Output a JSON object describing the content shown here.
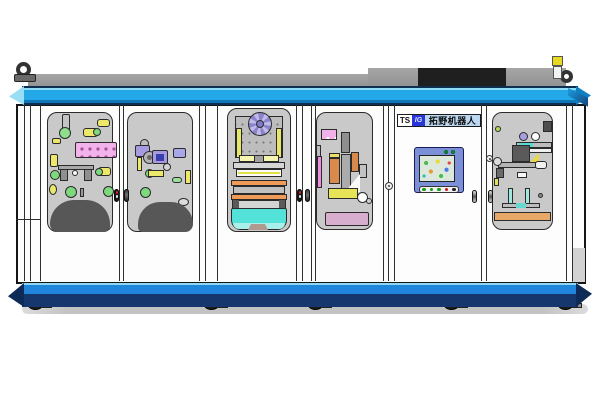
{
  "machine": {
    "label_plate": {
      "ts": "TS",
      "logo": "IG",
      "brand": "拓野机器人"
    },
    "colors": {
      "beam_cyan": "#25a8e8",
      "beam_bottom_blue": "#2285dc",
      "beam_navy": "#16366e",
      "body": "#fdfdfd",
      "window_bg": "#c9c9c9",
      "dome": "#575757",
      "tray_cyan": "#52e2da",
      "accent_orange": "#f09a58",
      "hmi_frame": "#7b90d6"
    },
    "hmi": {
      "indicator_colors": [
        "#129a12",
        "#129a12"
      ],
      "button_colors": [
        "#15a015",
        "#15a015",
        "#15a015",
        "#cc1515",
        "#222222"
      ]
    }
  },
  "scene": {
    "frame_lines": [
      24,
      30,
      40,
      119,
      123,
      199,
      205,
      217,
      296,
      302,
      311,
      315,
      383,
      388,
      394,
      481,
      486,
      566,
      572
    ],
    "windows": [
      {
        "id": "w1",
        "x": 47,
        "y": 112,
        "w": 66,
        "h": 120
      },
      {
        "id": "w2",
        "x": 127,
        "y": 112,
        "w": 66,
        "h": 120
      },
      {
        "id": "w3",
        "x": 227,
        "y": 108,
        "w": 64,
        "h": 124
      },
      {
        "id": "w4",
        "x": 316,
        "y": 112,
        "w": 57,
        "h": 118
      },
      {
        "id": "w6",
        "x": 492,
        "y": 112,
        "w": 61,
        "h": 118
      }
    ],
    "handles": [
      {
        "x": 114,
        "y": 189,
        "v": "lock"
      },
      {
        "x": 124,
        "y": 189,
        "v": "dark"
      },
      {
        "x": 297,
        "y": 189,
        "v": "lock"
      },
      {
        "x": 305,
        "y": 189,
        "v": "dark"
      },
      {
        "x": 472,
        "y": 190,
        "v": "light"
      },
      {
        "x": 488,
        "y": 190,
        "v": "light"
      }
    ],
    "knobs": [
      {
        "x": 385,
        "y": 182,
        "d": 8
      },
      {
        "x": 486,
        "y": 155,
        "d": 7
      }
    ],
    "casters": [
      36,
      212,
      316,
      452,
      566
    ],
    "components": [
      {
        "n": "air-cylinder",
        "x": 62,
        "y": 114,
        "w": 8,
        "h": 17,
        "c": "#c4c4c4",
        "r": "2px",
        "b": true
      },
      {
        "n": "cylinder-base",
        "x": 59,
        "y": 127,
        "w": 12,
        "h": 12,
        "c": "#8ede8e",
        "r": "50",
        "b": true
      },
      {
        "n": "sensor-yellow",
        "x": 97,
        "y": 119,
        "w": 13,
        "h": 8,
        "c": "#eee86a",
        "r": "3px",
        "b": true
      },
      {
        "n": "sensor-yellow",
        "x": 83,
        "y": 128,
        "w": 15,
        "h": 9,
        "c": "#eee86a",
        "r": "3px",
        "b": true
      },
      {
        "n": "sensor-end-green",
        "x": 93,
        "y": 128,
        "w": 8,
        "h": 8,
        "c": "#7ed87e",
        "r": "50",
        "b": true
      },
      {
        "n": "sensor-yellow",
        "x": 52,
        "y": 138,
        "w": 9,
        "h": 6,
        "c": "#eee86a",
        "r": "2px",
        "b": true
      },
      {
        "n": "valve-manifold",
        "x": 75,
        "y": 142,
        "w": 42,
        "h": 16,
        "c": "#f2b2ea",
        "r": "2px",
        "b": true,
        "cls": "dots"
      },
      {
        "n": "sensor-yellow",
        "x": 50,
        "y": 154,
        "w": 8,
        "h": 13,
        "c": "#eee86a",
        "r": "2px",
        "b": true
      },
      {
        "n": "indicator-green",
        "x": 50,
        "y": 170,
        "w": 10,
        "h": 10,
        "c": "#7ed87e",
        "r": "50",
        "b": true
      },
      {
        "n": "fixture-bar",
        "x": 58,
        "y": 165,
        "w": 36,
        "h": 5,
        "c": "#a8a8a8",
        "b": true
      },
      {
        "n": "fixture-post",
        "x": 60,
        "y": 169,
        "w": 8,
        "h": 12,
        "c": "#8f8f8f",
        "b": true
      },
      {
        "n": "fixture-post",
        "x": 84,
        "y": 169,
        "w": 8,
        "h": 12,
        "c": "#8f8f8f",
        "b": true
      },
      {
        "n": "fixture-hole",
        "x": 72,
        "y": 170,
        "w": 6,
        "h": 6,
        "c": "#f8f8f8",
        "r": "50",
        "b": true
      },
      {
        "n": "sensor-yellow",
        "x": 98,
        "y": 167,
        "w": 13,
        "h": 9,
        "c": "#eee86a",
        "r": "3px",
        "b": true
      },
      {
        "n": "sensor-end-green",
        "x": 95,
        "y": 168,
        "w": 8,
        "h": 8,
        "c": "#7ed87e",
        "r": "50",
        "b": true
      },
      {
        "n": "indicator-green",
        "x": 65,
        "y": 186,
        "w": 12,
        "h": 12,
        "c": "#7ed87e",
        "r": "50",
        "b": true
      },
      {
        "n": "indicator-green",
        "x": 103,
        "y": 186,
        "w": 11,
        "h": 11,
        "c": "#7ed87e",
        "r": "50",
        "b": true
      },
      {
        "n": "sensor-yellow",
        "x": 49,
        "y": 184,
        "w": 8,
        "h": 11,
        "c": "#e8e86a",
        "r": "50",
        "b": true
      },
      {
        "n": "pin",
        "x": 80,
        "y": 188,
        "w": 4,
        "h": 9,
        "c": "#9a9a9a",
        "b": true
      },
      {
        "n": "cover-dome",
        "x": 50,
        "y": 200,
        "w": 60,
        "h": 32,
        "c": "#575757",
        "r": "30px 30px 8px 10px"
      },
      {
        "n": "bearing",
        "x": 140,
        "y": 139,
        "w": 9,
        "h": 9,
        "c": "#bdbdbd",
        "r": "50",
        "b": true
      },
      {
        "n": "purple-block",
        "x": 135,
        "y": 145,
        "w": 15,
        "h": 12,
        "c": "#a89ae0",
        "r": "2px",
        "b": true
      },
      {
        "n": "motor-face",
        "x": 143,
        "y": 151,
        "w": 13,
        "h": 13,
        "c": "#b4b4b4",
        "r": "50",
        "b": true
      },
      {
        "n": "motor-hub",
        "x": 147,
        "y": 155,
        "w": 5,
        "h": 5,
        "c": "#666666",
        "r": "50"
      },
      {
        "n": "purple-block",
        "x": 152,
        "y": 150,
        "w": 16,
        "h": 14,
        "c": "#a89ae0",
        "r": "2px",
        "b": true
      },
      {
        "n": "purple-block-core",
        "x": 156,
        "y": 154,
        "w": 8,
        "h": 7,
        "c": "#3a3fae"
      },
      {
        "n": "violet-module",
        "x": 173,
        "y": 148,
        "w": 13,
        "h": 10,
        "c": "#a8a8e8",
        "r": "2px",
        "b": true
      },
      {
        "n": "sensor-yellow",
        "x": 137,
        "y": 157,
        "w": 5,
        "h": 14,
        "c": "#eee86a",
        "b": true
      },
      {
        "n": "indicator-green",
        "x": 145,
        "y": 169,
        "w": 9,
        "h": 9,
        "c": "#7ed87e",
        "r": "50",
        "b": true
      },
      {
        "n": "sensor-yellow",
        "x": 148,
        "y": 170,
        "w": 16,
        "h": 7,
        "c": "#eee86a",
        "b": true
      },
      {
        "n": "bearing",
        "x": 163,
        "y": 163,
        "w": 8,
        "h": 8,
        "c": "#d4d4d4",
        "r": "50",
        "b": true
      },
      {
        "n": "sensor-yellow",
        "x": 185,
        "y": 170,
        "w": 6,
        "h": 14,
        "c": "#eee86a",
        "b": true
      },
      {
        "n": "green-capsule",
        "x": 172,
        "y": 177,
        "w": 10,
        "h": 6,
        "c": "#9ede9e",
        "r": "3px",
        "b": true
      },
      {
        "n": "indicator-green",
        "x": 140,
        "y": 187,
        "w": 11,
        "h": 11,
        "c": "#7ed87e",
        "r": "50",
        "b": true
      },
      {
        "n": "bearing",
        "x": 178,
        "y": 198,
        "w": 11,
        "h": 8,
        "c": "#dcdcdc",
        "r": "50",
        "b": true
      },
      {
        "n": "cover-dome",
        "x": 138,
        "y": 202,
        "w": 55,
        "h": 30,
        "c": "#575757",
        "r": "28px 28px 10px 6px"
      },
      {
        "n": "press-plate",
        "x": 235,
        "y": 116,
        "w": 48,
        "h": 42,
        "c": "#bdbdbd",
        "b": true,
        "cls": "dots-sm"
      },
      {
        "n": "side-rail-yellow",
        "x": 236,
        "y": 128,
        "w": 6,
        "h": 30,
        "c": "#e6e66a",
        "b": true
      },
      {
        "n": "side-rail-yellow",
        "x": 276,
        "y": 128,
        "w": 6,
        "h": 30,
        "c": "#e6e66a",
        "b": true
      },
      {
        "n": "index-wheel",
        "x": 248,
        "y": 112,
        "w": 24,
        "h": 24,
        "r": "50",
        "b": true,
        "cls": "wheel"
      },
      {
        "n": "index-wheel-hub",
        "x": 256,
        "y": 120,
        "w": 8,
        "h": 8,
        "c": "#8079c8",
        "r": "50",
        "b": true
      },
      {
        "n": "pale-bar",
        "x": 239,
        "y": 155,
        "w": 40,
        "h": 7,
        "c": "#f4f4b0",
        "b": true
      },
      {
        "n": "center-bracket",
        "x": 254,
        "y": 155,
        "w": 10,
        "h": 11,
        "c": "#a0a0a0",
        "b": true
      },
      {
        "n": "cross-bar",
        "x": 233,
        "y": 162,
        "w": 52,
        "h": 7,
        "c": "#d6d6d6",
        "b": true
      },
      {
        "n": "roller-bed",
        "x": 236,
        "y": 169,
        "w": 46,
        "h": 8,
        "c": "#fafafa",
        "b": true
      },
      {
        "n": "roller-line",
        "x": 238,
        "y": 172,
        "w": 42,
        "h": 2,
        "c": "#e0e040"
      },
      {
        "n": "orange-rail",
        "x": 231,
        "y": 180,
        "w": 56,
        "h": 6,
        "c": "#f09a58",
        "b": true
      },
      {
        "n": "gray-band",
        "x": 233,
        "y": 186,
        "w": 52,
        "h": 8,
        "c": "#c0c0c0",
        "b": true
      },
      {
        "n": "orange-rail",
        "x": 231,
        "y": 194,
        "w": 56,
        "h": 6,
        "c": "#f09a58",
        "b": true
      },
      {
        "n": "tray-body",
        "x": 232,
        "y": 200,
        "w": 54,
        "h": 9,
        "c": "#d4d4d4",
        "b": true
      },
      {
        "n": "tray-corner",
        "x": 233,
        "y": 200,
        "w": 6,
        "h": 8,
        "c": "#5a5a5a"
      },
      {
        "n": "tray-corner",
        "x": 279,
        "y": 200,
        "w": 6,
        "h": 8,
        "c": "#5a5a5a"
      },
      {
        "n": "outfeed-cyan",
        "x": 231,
        "y": 208,
        "w": 56,
        "h": 22,
        "c": "#52e2da",
        "r": "2px 2px 10px 10px",
        "b": true
      },
      {
        "n": "outfeed-cyan-lip",
        "x": 233,
        "y": 223,
        "w": 52,
        "h": 6,
        "c": "#aaf0ea",
        "r": "0 0 8px 8px"
      },
      {
        "n": "outfeed-shadow",
        "x": 248,
        "y": 224,
        "w": 20,
        "h": 6,
        "c": "#b09a90",
        "cls": "tri-trap"
      },
      {
        "n": "rail-gray",
        "x": 316,
        "y": 145,
        "w": 5,
        "h": 43,
        "c": "#bdbdbd",
        "b": true
      },
      {
        "n": "pink-plate",
        "x": 321,
        "y": 129,
        "w": 16,
        "h": 11,
        "c": "#f0b0e8",
        "b": true,
        "cls": "dots2"
      },
      {
        "n": "vertical-post",
        "x": 341,
        "y": 132,
        "w": 9,
        "h": 21,
        "c": "#8f8f8f",
        "b": true
      },
      {
        "n": "pink-strip",
        "x": 317,
        "y": 156,
        "w": 5,
        "h": 32,
        "c": "#ee8ee0",
        "b": true
      },
      {
        "n": "cylinder-cap",
        "x": 329,
        "y": 153,
        "w": 11,
        "h": 5,
        "c": "#e8e06a",
        "b": true
      },
      {
        "n": "copper-cylinder",
        "x": 329,
        "y": 158,
        "w": 11,
        "h": 26,
        "c": "#d88a4c",
        "b": true
      },
      {
        "n": "gray-assembly",
        "x": 341,
        "y": 154,
        "w": 10,
        "h": 36,
        "c": "#ababab",
        "b": true
      },
      {
        "n": "copper-cylinder",
        "x": 351,
        "y": 152,
        "w": 8,
        "h": 20,
        "c": "#d88a4c",
        "b": true
      },
      {
        "n": "gray-block",
        "x": 359,
        "y": 164,
        "w": 8,
        "h": 14,
        "c": "#c2c2c2",
        "b": true
      },
      {
        "n": "highlight-wedge",
        "x": 345,
        "y": 174,
        "w": 15,
        "h": 18,
        "c": "#fafafa",
        "cls": "tri-bl"
      },
      {
        "n": "yellow-block-row",
        "x": 328,
        "y": 188,
        "w": 30,
        "h": 11,
        "c": "#e8e458",
        "b": true
      },
      {
        "n": "white-disc",
        "x": 357,
        "y": 192,
        "w": 11,
        "h": 11,
        "c": "#fdfdfd",
        "r": "50",
        "b": true
      },
      {
        "n": "small-disc",
        "x": 366,
        "y": 198,
        "w": 6,
        "h": 6,
        "c": "#d0d0d0",
        "r": "50",
        "b": true
      },
      {
        "n": "mauve-base",
        "x": 325,
        "y": 212,
        "w": 44,
        "h": 14,
        "c": "#d8aece",
        "r": "2px",
        "b": true
      },
      {
        "n": "dark-block",
        "x": 543,
        "y": 121,
        "w": 9,
        "h": 11,
        "c": "#4e4e4e",
        "b": true
      },
      {
        "n": "green-dot",
        "x": 495,
        "y": 126,
        "w": 6,
        "h": 6,
        "c": "#b8d858",
        "r": "50",
        "b": true
      },
      {
        "n": "gear-disc",
        "x": 519,
        "y": 132,
        "w": 9,
        "h": 9,
        "c": "#a79fe0",
        "r": "50",
        "b": true
      },
      {
        "n": "ring-disc",
        "x": 531,
        "y": 132,
        "w": 9,
        "h": 9,
        "c": "#fdfdfd",
        "r": "50",
        "b": true
      },
      {
        "n": "linear-rail",
        "x": 516,
        "y": 142,
        "w": 36,
        "h": 6,
        "c": "#bdbdbd",
        "b": true
      },
      {
        "n": "rail-cyan-seg",
        "x": 519,
        "y": 143,
        "w": 14,
        "h": 4,
        "c": "#55dcd4"
      },
      {
        "n": "rail-white-bar",
        "x": 516,
        "y": 148,
        "w": 36,
        "h": 5,
        "c": "#f0f0f0",
        "b": true
      },
      {
        "n": "dark-module",
        "x": 512,
        "y": 145,
        "w": 18,
        "h": 17,
        "c": "#5a5a5a",
        "b": true
      },
      {
        "n": "yellow-wedge",
        "x": 530,
        "y": 153,
        "w": 9,
        "h": 9,
        "c": "#e8d84a",
        "cls": "tri-tl"
      },
      {
        "n": "horizontal-arm",
        "x": 498,
        "y": 162,
        "w": 40,
        "h": 6,
        "c": "#b4b4b4",
        "b": true
      },
      {
        "n": "arm-cylinder",
        "x": 535,
        "y": 161,
        "w": 12,
        "h": 8,
        "c": "#f0f0f0",
        "r": "3px",
        "b": true
      },
      {
        "n": "clamp-disc",
        "x": 493,
        "y": 157,
        "w": 9,
        "h": 9,
        "c": "#dcdcdc",
        "r": "50",
        "b": true
      },
      {
        "n": "clamp-body",
        "x": 496,
        "y": 168,
        "w": 8,
        "h": 10,
        "c": "#6a6a6a",
        "b": true
      },
      {
        "n": "clamp-yellow",
        "x": 494,
        "y": 178,
        "w": 5,
        "h": 8,
        "c": "#e0e05a",
        "b": true
      },
      {
        "n": "white-block",
        "x": 517,
        "y": 172,
        "w": 10,
        "h": 6,
        "c": "#f6f6f6",
        "b": true
      },
      {
        "n": "cyan-post",
        "x": 508,
        "y": 188,
        "w": 5,
        "h": 16,
        "c": "#9fe8e0",
        "b": true
      },
      {
        "n": "cyan-post",
        "x": 525,
        "y": 188,
        "w": 5,
        "h": 16,
        "c": "#9fe8e0",
        "b": true
      },
      {
        "n": "gray-dot",
        "x": 538,
        "y": 193,
        "w": 5,
        "h": 5,
        "c": "#8a8a8a",
        "r": "50",
        "b": true
      },
      {
        "n": "base-plate",
        "x": 502,
        "y": 203,
        "w": 38,
        "h": 5,
        "c": "#bdbdbd",
        "b": true
      },
      {
        "n": "base-cyan-seg",
        "x": 516,
        "y": 203,
        "w": 10,
        "h": 5,
        "c": "#66d8d0"
      },
      {
        "n": "tan-base-bar",
        "x": 494,
        "y": 212,
        "w": 57,
        "h": 9,
        "c": "#e8a868",
        "b": true
      }
    ]
  }
}
